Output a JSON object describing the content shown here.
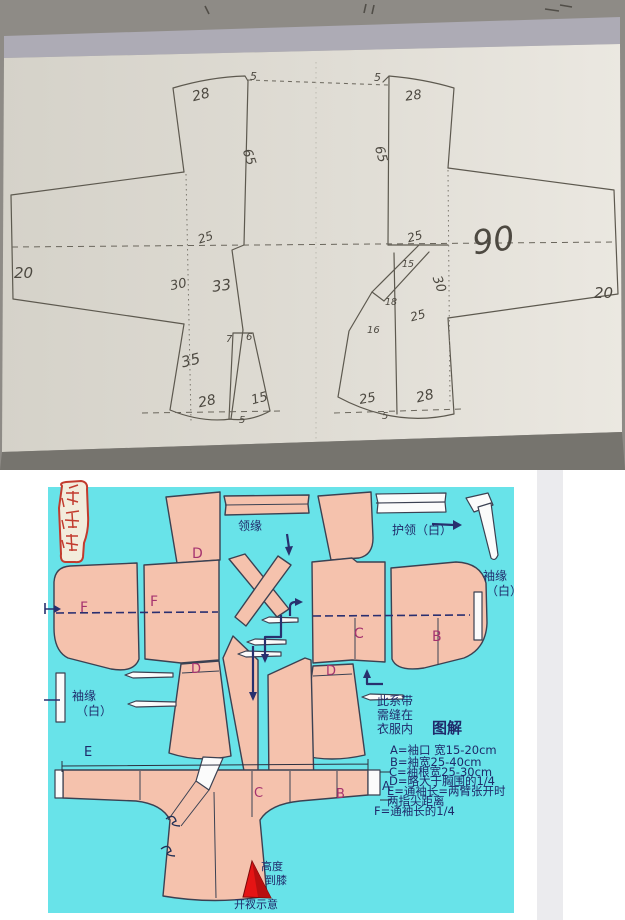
{
  "photo": {
    "left_sleeve_width": "20",
    "lb_top": "28",
    "lb_tick5": "5",
    "lb_len65": "65",
    "lb_25": "25",
    "lb_30": "30",
    "lb_33": "33",
    "lb_7": "7",
    "lb_6": "6",
    "lb_35": "35",
    "lb_hem28": "28",
    "lb_hem15": "15",
    "lb_hem5": "5",
    "rb_tick5": "5",
    "rb_top": "28",
    "rb_len65": "65",
    "rb_25": "25",
    "rb_15": "15",
    "rb_30": "30",
    "rb_18": "18",
    "rb_mid25": "25",
    "rb_16": "16",
    "rb_hem25": "25",
    "rb_hem28": "28",
    "rb_hem5": "5",
    "right_sleeve_width": "20",
    "size90": "90"
  },
  "diagram": {
    "labels": {
      "d_top": "D",
      "f_sleeve": "F",
      "f_body": "F",
      "d_left": "D",
      "c_body": "C",
      "b_sleeve": "B",
      "d_right": "D",
      "e_dim": "E",
      "a_cuff": "A",
      "c_lower": "C",
      "b_lower": "B"
    },
    "collar_trim": "领缘",
    "collar_guard": "护领（白）",
    "sleeve_trim_1": "袖缘",
    "sleeve_trim_2": "（白）",
    "tie_note": [
      "此系带",
      "需缝在",
      "衣服内"
    ],
    "legend_title": "图解",
    "legend": [
      "A=袖口 宽15-20cm",
      "B=袖宽25-40cm",
      "C=袖根宽25-30cm",
      "D=略大于胸围的1/4",
      "E=通袖长=两臂张开时",
      "两指尖距离",
      "F=通袖长的1/4"
    ],
    "slit_height": [
      "高度",
      "到膝"
    ],
    "slit_caption": "开衩示意",
    "colors": {
      "cyan": "#68e3e9",
      "piece": "#f5c2ad",
      "outline": "#3b4152",
      "navy": "#28306e",
      "magenta": "#a6336f",
      "legend_ink": "#1f2a6a",
      "red": "#e51414",
      "seal_red": "#c23b2e"
    }
  }
}
